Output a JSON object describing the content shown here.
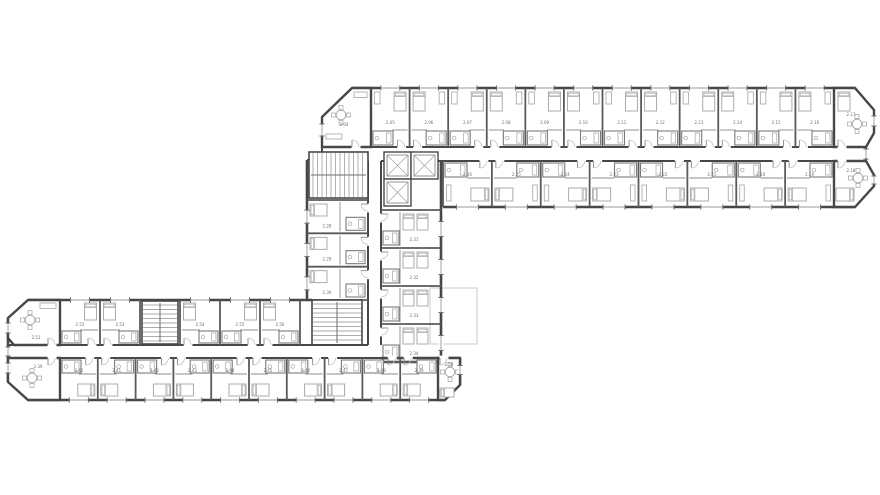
{
  "page": {
    "background": "#ffffff",
    "width": 880,
    "height": 495
  },
  "palette": {
    "wall": "#474747",
    "wall_light": "#6e6e6e",
    "partition": "#8b8b8b",
    "furniture": "#a3a3a3",
    "fixture": "#7a7a7a",
    "label": "#6e6e6e",
    "door_arc": "#c4c4c4",
    "door_leaf": "#8a8a8a",
    "window_line": "#9a9a9a",
    "window_tick": "#6f6f6f",
    "stair_tread": "#8f8f8f",
    "terrace_outline": "#cbcbcb"
  },
  "floor_plan": {
    "upper_wing": {
      "lounge_label": "2.04",
      "rooms_top": [
        "2.05",
        "2.06",
        "2.07",
        "2.08",
        "2.09",
        "2.10",
        "2.11",
        "2.12",
        "2.13",
        "2.14",
        "2.15",
        "2.16"
      ],
      "corner_top_right": "2.17",
      "corner_bottom_right": "2.18",
      "rooms_bottom": [
        "2.26",
        "2.25",
        "2.24",
        "2.23",
        "2.22",
        "2.21",
        "2.20",
        "2.19"
      ]
    },
    "core": {
      "rooms_left": [
        "2.28",
        "2.29",
        "2.30"
      ],
      "rooms_right": [
        "2.31",
        "2.32",
        "2.33",
        "2.34"
      ]
    },
    "lower_wing": {
      "corner_top_left": "2.51",
      "rooms_top": [
        "2.52",
        "2.53",
        "2.54",
        "2.55",
        "2.56"
      ],
      "corner_bottom_left": "2.39",
      "rooms_bottom": [
        "2.40",
        "2.41",
        "2.42",
        "2.43",
        "2.44",
        "2.45",
        "2.46",
        "2.47",
        "2.48",
        "2.49"
      ],
      "corner_bottom_right": "2.50"
    }
  }
}
